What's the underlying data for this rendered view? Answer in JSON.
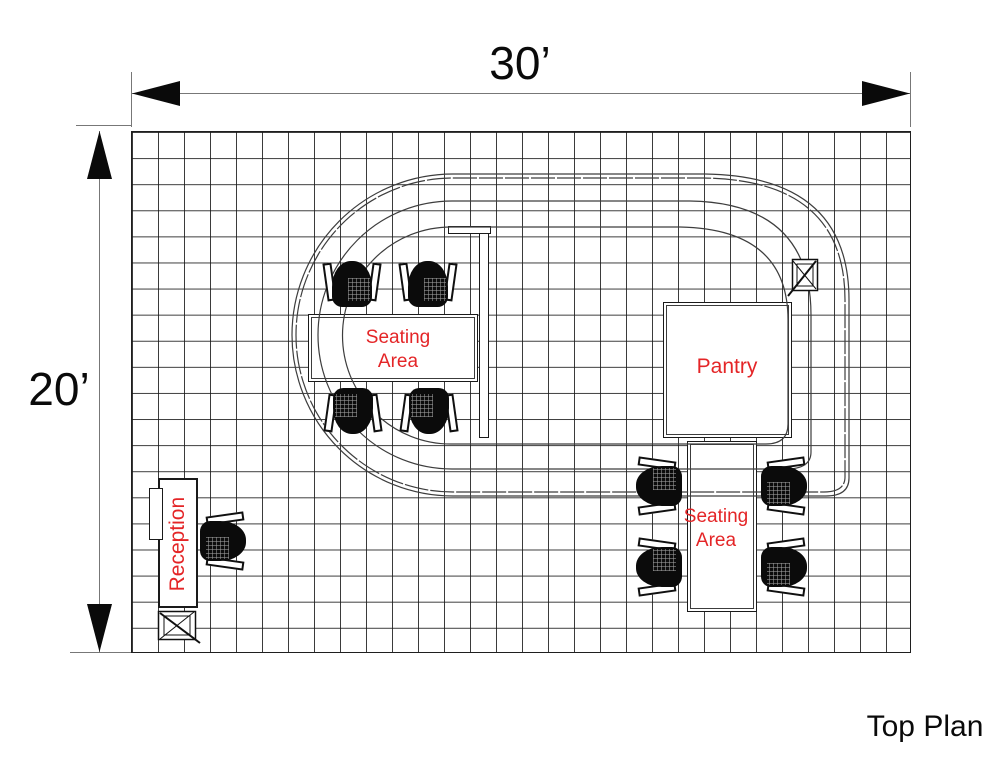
{
  "plan": {
    "title": "Top Plan"
  },
  "dimensions": {
    "width": "30’",
    "height": "20’"
  },
  "rooms": {
    "seating_area_1": "Seating Area",
    "pantry": "Pantry",
    "seating_area_2": "Seating Area",
    "reception": "Reception"
  },
  "grid": {
    "columns": 30,
    "rows": 20
  },
  "colors": {
    "label_red": "#e42527",
    "drawing_line": "#1a1a1a",
    "dimension_line": "#777777",
    "chair_fill": "#0b0b0b"
  },
  "icons": {
    "junction_box_top_right": "crossed-box-icon",
    "junction_box_reception": "crossed-box-icon"
  }
}
